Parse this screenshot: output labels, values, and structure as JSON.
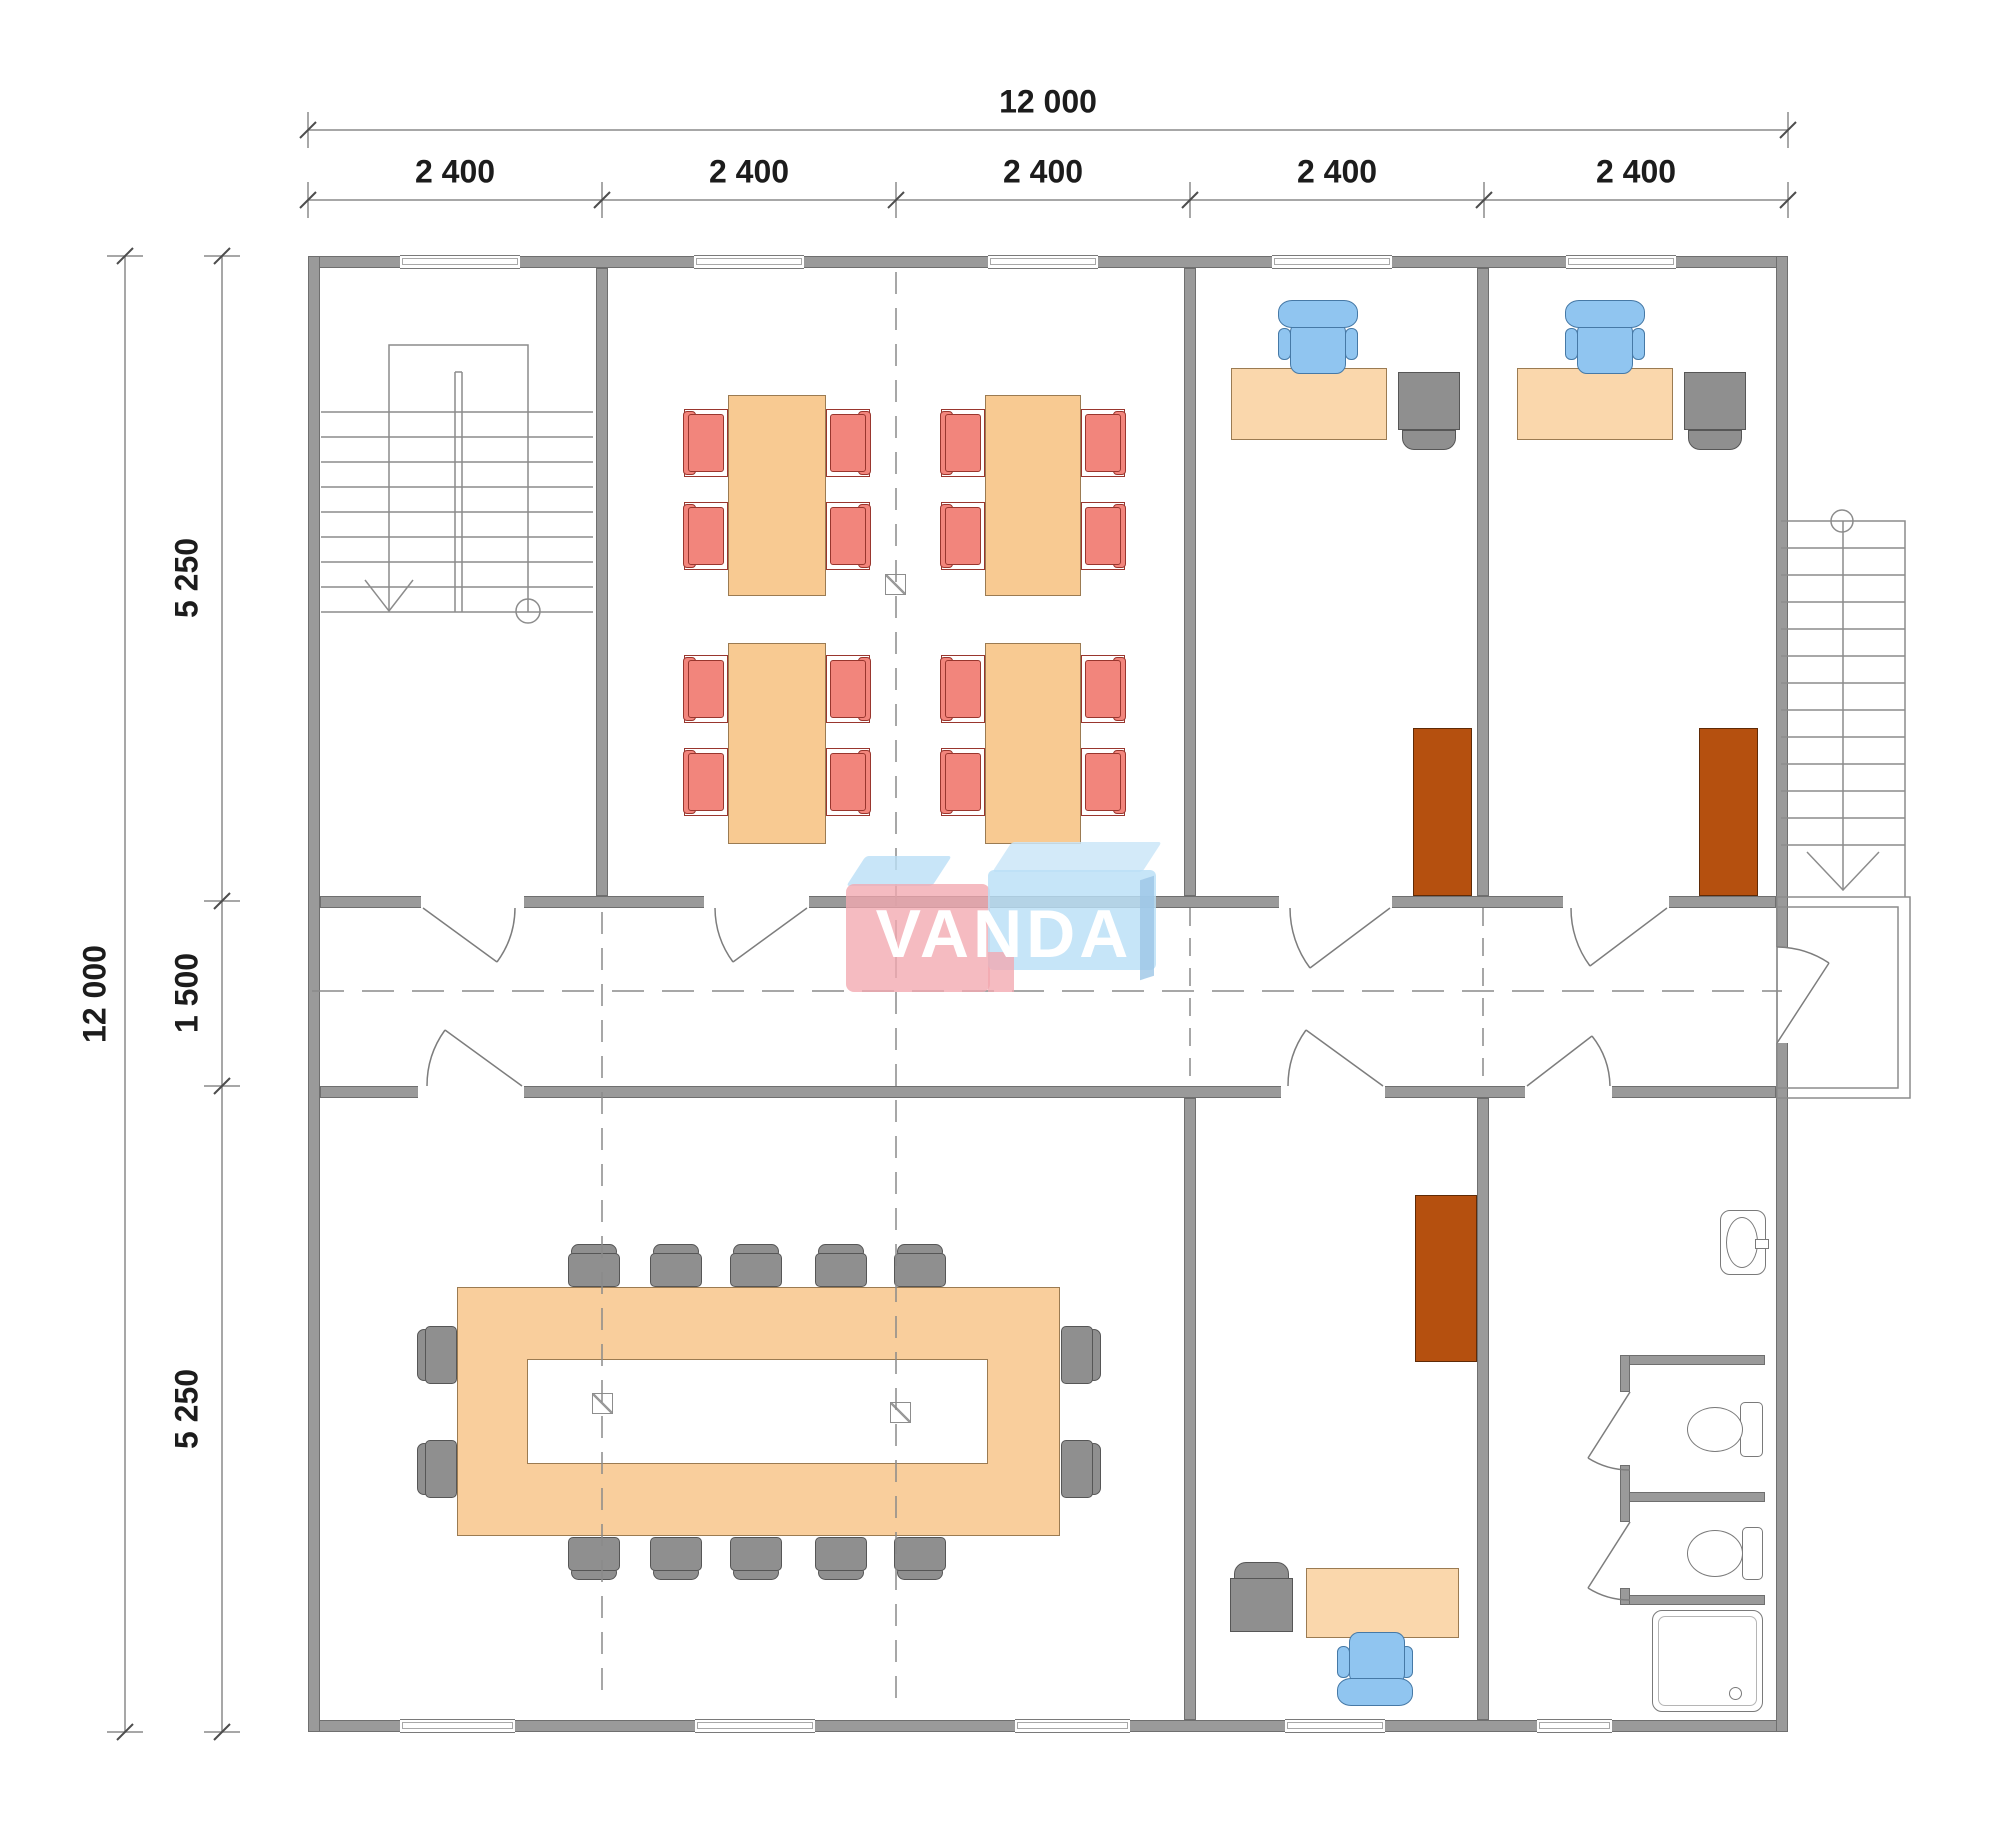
{
  "document": {
    "type": "architectural floor plan",
    "description": "Single-storey modular office building plan 12000 x 12000 mm with classroom, two offices, conference room, office, washroom, internal stairwell and external staircase with landing"
  },
  "watermark": {
    "text": "VANDA"
  },
  "dimensions": {
    "top": {
      "overall": "12 000",
      "segments": [
        "2 400",
        "2 400",
        "2 400",
        "2 400",
        "2 400"
      ]
    },
    "left": {
      "overall": "12 000",
      "segments": [
        "5 250",
        "1 500",
        "5 250"
      ]
    }
  },
  "colors": {
    "wall": "#9a9a9a",
    "wall_edge": "#6f6f6f",
    "line": "#7a7a7a",
    "dim": "#1c1c1c",
    "table": "#F8CA92",
    "desk": "#FAD7AC",
    "conf": "#F9CE9C",
    "table_edge": "#9b7b52",
    "chair_red": "#F2857C",
    "chair_red_edge": "#99362e",
    "chair_blue": "#90C5F0",
    "chair_blue_edge": "#4679a6",
    "furn_gray": "#8f8f8f",
    "furn_gray_edge": "#565656",
    "cabinet": "#B5500F",
    "cabinet_edge": "#5f2a06",
    "logo_pink": "#F2A8AF",
    "logo_blue": "#BADFF6",
    "logo_blue_light": "#CBE6F8",
    "logo_blue_dark": "#9CC6E6"
  },
  "rooms": [
    {
      "name": "stairwell",
      "furniture": [
        "internal staircase with down arrow"
      ]
    },
    {
      "name": "classroom",
      "furniture": [
        "4 tables",
        "16 red chairs"
      ]
    },
    {
      "name": "office-1",
      "furniture": [
        "desk",
        "blue office chair",
        "gray side unit",
        "brown cabinet"
      ]
    },
    {
      "name": "office-2",
      "furniture": [
        "desk",
        "blue office chair",
        "gray side unit",
        "brown cabinet"
      ]
    },
    {
      "name": "conference-room",
      "furniture": [
        "ring conference table",
        "14 gray chairs"
      ]
    },
    {
      "name": "office-3",
      "furniture": [
        "desk",
        "blue office chair",
        "gray side unit",
        "brown cabinet"
      ]
    },
    {
      "name": "washroom",
      "furniture": [
        "wash basin",
        "2 WC stalls with toilets",
        "shower tray"
      ]
    },
    {
      "name": "exterior",
      "furniture": [
        "external staircase",
        "entrance landing"
      ]
    }
  ]
}
